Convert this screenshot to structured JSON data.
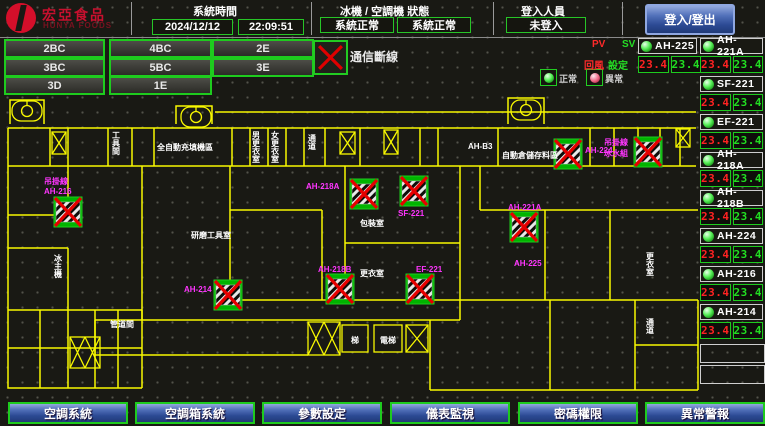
{
  "header": {
    "logo": {
      "name": "宏亞食品",
      "sub": "HUNYA FOODS"
    },
    "system_time": {
      "label": "系統時間",
      "date": "2024/12/12",
      "time": "22:09:51"
    },
    "machine_status": {
      "label": "冰機 / 空調機 狀態",
      "chiller_status": "系統正常",
      "ahu_status": "系統正常"
    },
    "login": {
      "label": "登入人員",
      "user": "未登入",
      "button_label": "登入/登出"
    }
  },
  "floor_buttons": [
    "2BC",
    "4BC",
    "2E",
    "3BC",
    "5BC",
    "3E",
    "3D",
    "1E"
  ],
  "legend": {
    "comm_loss": "通信斷線",
    "normal": "正常",
    "abnormal": "異常"
  },
  "monitor": {
    "pv": "PV",
    "sv": "SV",
    "pv_row": "回風",
    "sv_row": "設定",
    "units": [
      {
        "name": "AH-225",
        "pv": "23.4",
        "sv": "23.4"
      },
      {
        "name": "AH-221A",
        "pv": "23.4",
        "sv": "23.4"
      },
      {
        "name": "SF-221",
        "pv": "23.4",
        "sv": "23.4"
      },
      {
        "name": "EF-221",
        "pv": "23.4",
        "sv": "23.4"
      },
      {
        "name": "AH-218A",
        "pv": "23.4",
        "sv": "23.4"
      },
      {
        "name": "AH-218B",
        "pv": "23.4",
        "sv": "23.4"
      },
      {
        "name": "AH-224",
        "pv": "23.4",
        "sv": "23.4"
      },
      {
        "name": "AH-216",
        "pv": "23.4",
        "sv": "23.4"
      },
      {
        "name": "AH-214",
        "pv": "23.4",
        "sv": "23.4"
      }
    ]
  },
  "floorplan": {
    "rooms": {
      "tool_room": "工具間",
      "auto_fill": "全自動充填機區",
      "locker_m": "男更衣室",
      "locker_f": "女更衣室",
      "corridor_top": "通道",
      "ah_b3": "AH-B3",
      "storage": "自動倉儲存料區",
      "grinding": "研磨工具室",
      "packing": "包裝室",
      "locker_center": "更衣室",
      "chiller_room": "冰主機",
      "duct": "管道間",
      "stair": "梯",
      "elevator": "電梯",
      "locker_right": "更衣室",
      "corridor_right": "通道"
    },
    "equipment_labels": {
      "hang_left_1": "吊掛線",
      "hang_left_2": "AH-216",
      "ah214": "AH-214",
      "ah218a": "AH-218A",
      "sf221": "SF-221",
      "ah218b": "AH-218B",
      "ef221": "EF-221",
      "ah221a": "AH-221A",
      "ah224": "AH-224",
      "hang_right_1": "吊掛線",
      "hang_right_2": "冰水組",
      "ah225": "AH-225"
    }
  },
  "nav": {
    "items": [
      "空調系統",
      "空調箱系統",
      "參數設定",
      "儀表監視",
      "密碼權限",
      "異常警報"
    ]
  },
  "colors": {
    "accent_green": "#1ecb1e",
    "alarm_red": "#ff2222",
    "setpoint_green": "#22dd22",
    "magenta": "#ff35ff",
    "plan_yellow": "#f8f800",
    "nav_blue": "#2c4a94",
    "logo_red": "#c8102e"
  }
}
